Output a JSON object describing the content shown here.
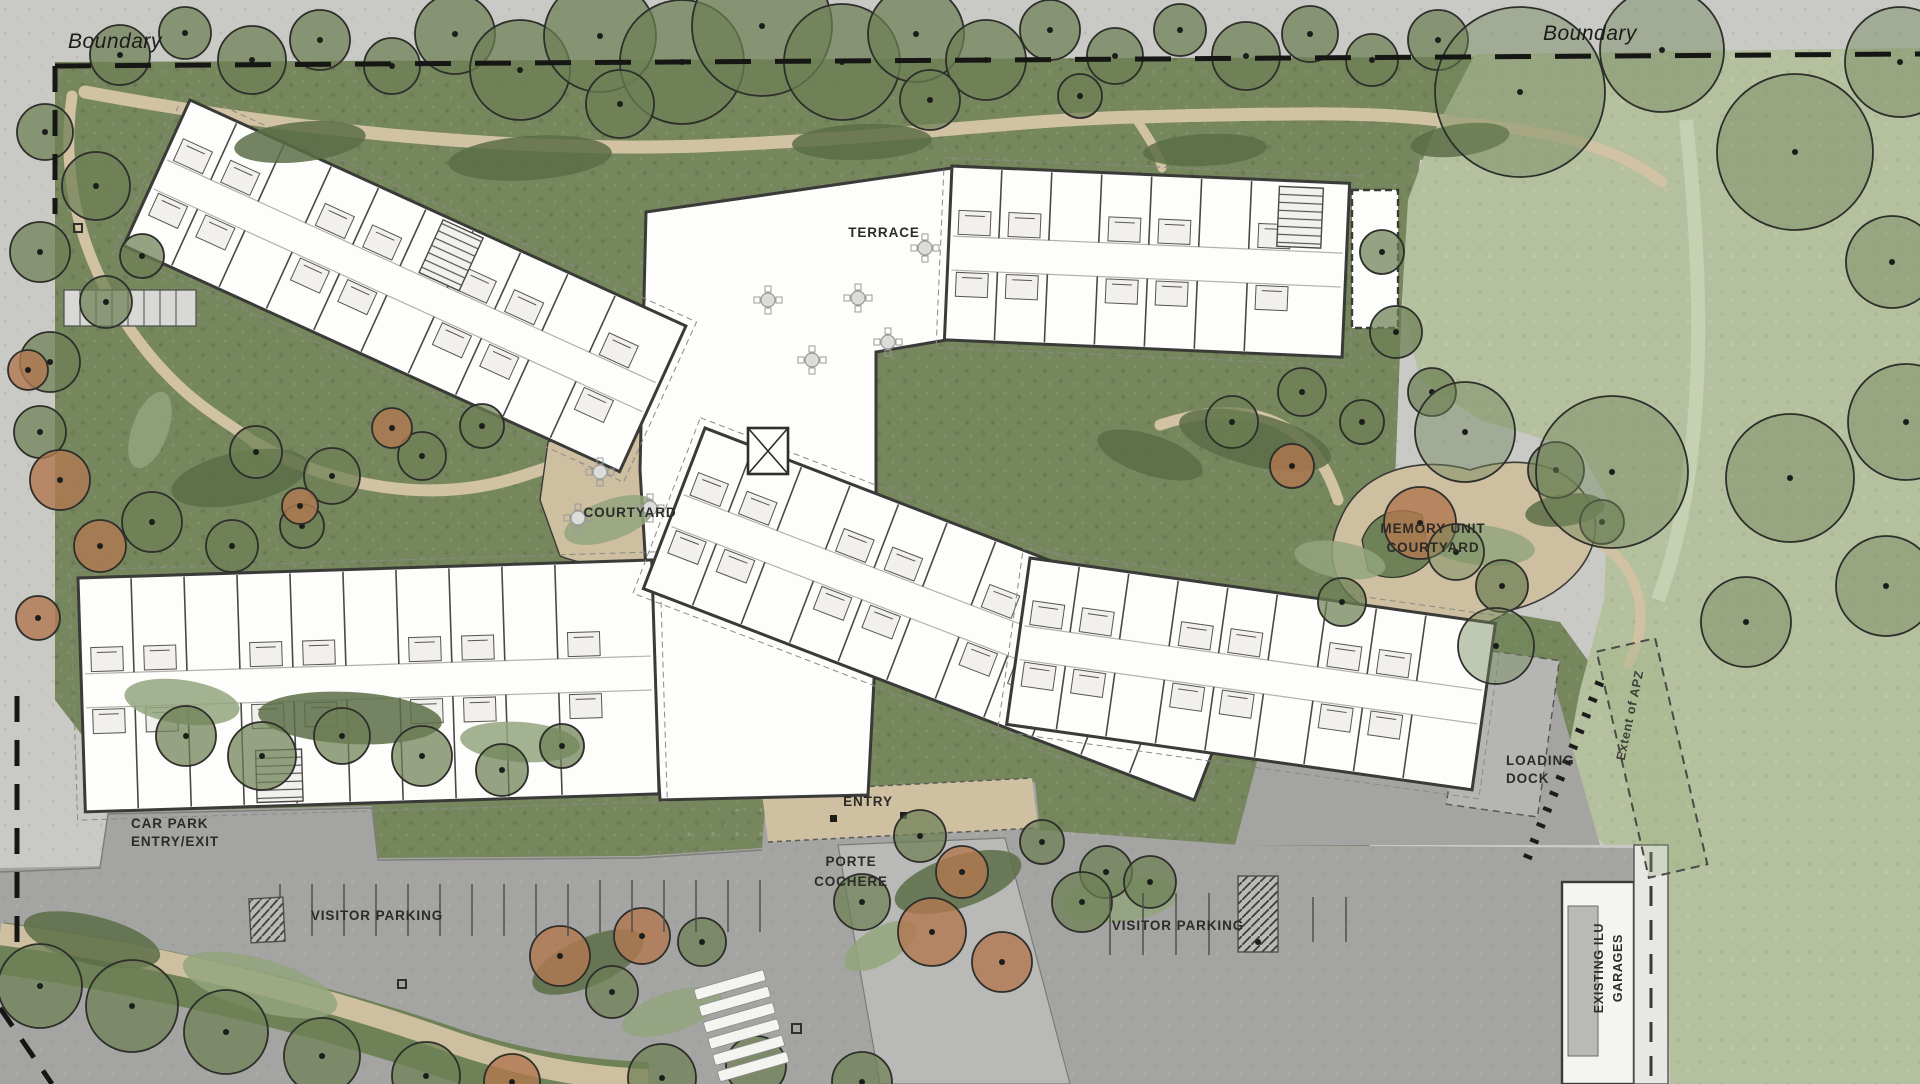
{
  "colors": {
    "base_gray": "#c9c9c6",
    "road_gray": "#a4a4a2",
    "garden_green": "#76875e",
    "garden_dark": "#5c6d46",
    "lawn_green": "#b5c09f",
    "tree_green": "#6e8055",
    "tree_outline": "#2e2e2a",
    "autumn_orange": "#b17850",
    "path_tan": "#d1c2a4",
    "terrace_tan": "#c9b999",
    "building_white": "#fdfdfb",
    "wall_dark": "#3a3a38",
    "label_ink": "#2b2b28",
    "porte_gray": "#b9b9b7"
  },
  "labels": {
    "boundary_left": "Boundary",
    "boundary_right": "Boundary",
    "terrace": "TERRACE",
    "courtyard": "COURTYARD",
    "memory_unit": [
      "MEMORY UNIT",
      "COURTYARD"
    ],
    "car_park": [
      "CAR PARK",
      "ENTRY/EXIT"
    ],
    "visitor_parking_west": "VISITOR PARKING",
    "visitor_parking_east": "VISITOR PARKING",
    "entry": "ENTRY",
    "porte_cochere": [
      "PORTE",
      "COCHERE"
    ],
    "loading_dock": [
      "LOADING",
      "DOCK"
    ],
    "existing_ilu": [
      "EXISTING ILU",
      "GARAGES"
    ],
    "extent_apz": "Extent of APZ"
  }
}
